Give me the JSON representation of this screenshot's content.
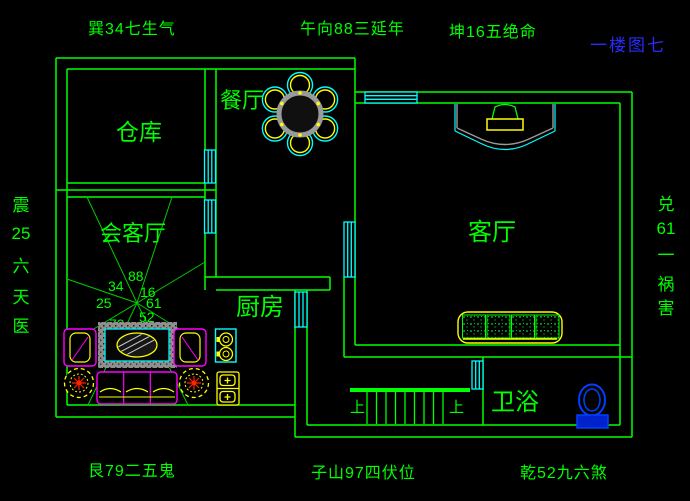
{
  "colors": {
    "background": "#000000",
    "wall_green": "#00ff00",
    "window_cyan": "#00ffff",
    "furniture_yellow": "#ffff00",
    "furniture_magenta": "#ff00ff",
    "rug_gray": "#8f8f8f",
    "toilet_blue": "#0040ff",
    "title_blue": "#2a2aff"
  },
  "title": "一楼图七",
  "annotations": {
    "top": [
      "巽34七生气",
      "午向88三延年",
      "坤16五绝命"
    ],
    "bottom": [
      "艮79二五鬼",
      "子山97四伏位",
      "乾52九六煞"
    ],
    "left_vertical": [
      "震",
      "25",
      "六",
      "天",
      "医"
    ],
    "right_vertical": [
      "兑",
      "61",
      "一",
      "祸",
      "害"
    ]
  },
  "rooms": {
    "storage": "仓库",
    "reception": "会客厅",
    "dining": "餐厅",
    "kitchen": "厨房",
    "living": "客厅",
    "bathroom": "卫浴"
  },
  "fan_numbers": {
    "top": "88",
    "top_left": "34",
    "top_right": "16",
    "left": "25",
    "right": "61",
    "bottom_left": "79",
    "bottom_right": "52"
  },
  "stairs": {
    "label_left": "上",
    "label_right": "上"
  }
}
